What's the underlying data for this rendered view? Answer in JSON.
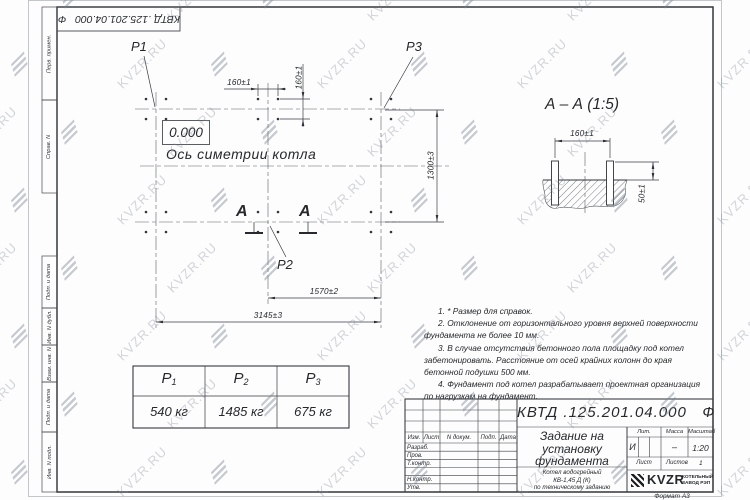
{
  "watermark_text": "KVZR.RU",
  "margin_boxes": [
    {
      "label": "Перв. примен."
    },
    {
      "label": "Справ. N"
    },
    {
      "label": "Подп. и дата"
    },
    {
      "label": "Инв. N дубл."
    },
    {
      "label": "Взам. инв. N"
    },
    {
      "label": "Подп. и дата"
    },
    {
      "label": "Инв. N подл."
    }
  ],
  "plan": {
    "p1": "Р1",
    "p2": "Р2",
    "p3": "Р3",
    "level": "0.000",
    "axis_label": "Ось симетрии котла",
    "section_letter_left": "А",
    "section_letter_right": "А",
    "dim_160_top": "160±1",
    "dim_160_side": "160±1",
    "dim_1300": "1300±3",
    "dim_1570": "1570±2",
    "dim_3145": "3145±3"
  },
  "section_view": {
    "title": "А – А (1:5)",
    "dim_160": "160±1",
    "dim_50": "50±1"
  },
  "notes": [
    "1. * Размер для справок.",
    "2. Отклонение от горизонтального уровня верхней поверхности фундамента не более 10 мм.",
    "3. В случае отсутствия бетонного пола площадку под котел забетонировать. Расстояние от осей крайних колонн до края бетонной подушки 500 мм.",
    "4. Фундамент под котел разрабатывает проектная организация по нагрузкам на фундамент."
  ],
  "load_table": {
    "symbol": "Р",
    "subscripts": [
      "1",
      "2",
      "3"
    ],
    "values": [
      "540 кг",
      "1485 кг",
      "675 кг"
    ]
  },
  "title_block": {
    "designation": "КВТД .125.201.04.000   Ф",
    "doc_title_lines": [
      "Задание на",
      "установку",
      "фундамента"
    ],
    "product_lines": [
      "Котел водогрейный",
      "КВ-1,45 Д (К)",
      "по техническому заданию"
    ],
    "header_cells": [
      "Изм.",
      "Лист",
      "N докум.",
      "Подп.",
      "Дата"
    ],
    "sign_rows": [
      "Разраб.",
      "Пров.",
      "Т.контр.",
      "",
      "Н.контр.",
      "Утв."
    ],
    "lit_label": "Лит.",
    "lit_value": "И",
    "mass_label": "Масса",
    "mass_value": "–",
    "scale_label": "Масштаб",
    "scale_value": "1:20",
    "sheet_label": "Лист",
    "sheets_label": "Листов",
    "sheets_value": "1",
    "company": {
      "logo_text": "KVZR",
      "name_line1": "КОТЕЛЬНЫЙ",
      "name_line2": "ЗАВОД РЭП"
    },
    "format_note": "Формат А3"
  }
}
